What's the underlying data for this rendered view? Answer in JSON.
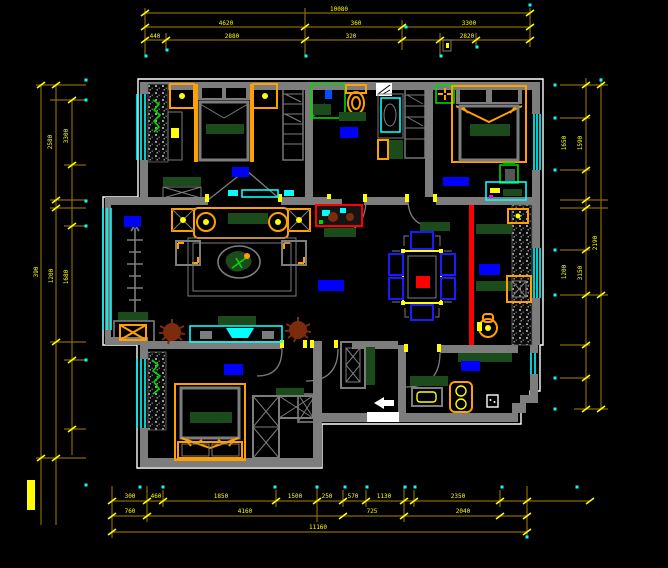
{
  "drawing": {
    "kind": "apartment floor plan (CAD)",
    "background": "#000000"
  },
  "palette": {
    "bg": "#000000",
    "wall": "#7d7d7d",
    "outline": "#ffffff",
    "dim_line": "#8a6a00",
    "dim_text": "#ffff00",
    "yellow": "#ffff00",
    "cyan": "#00ffff",
    "orange": "#ffa000",
    "dgreen": "#1b4a1b",
    "green": "#00d800",
    "chair_blue": "#1a1aff",
    "label_blue": "#0000ff",
    "red": "#ff0000",
    "brown": "#7c2b0c"
  },
  "dimensions": {
    "top": [
      {
        "x": 339,
        "y": 11,
        "v": "10080",
        "rot": 0
      },
      {
        "x": 226,
        "y": 25,
        "v": "4620",
        "rot": 0
      },
      {
        "x": 356,
        "y": 25,
        "v": "360",
        "rot": 0
      },
      {
        "x": 469,
        "y": 25,
        "v": "3300",
        "rot": 0
      },
      {
        "x": 155,
        "y": 38,
        "v": "440",
        "rot": 0
      },
      {
        "x": 232,
        "y": 38,
        "v": "2880",
        "rot": 0
      },
      {
        "x": 351,
        "y": 38,
        "v": "320",
        "rot": 0
      },
      {
        "x": 467,
        "y": 38,
        "v": "2820",
        "rot": 0
      }
    ],
    "bottom": [
      {
        "x": 130,
        "y": 498,
        "v": "300",
        "rot": 0
      },
      {
        "x": 156,
        "y": 498,
        "v": "460",
        "rot": 0
      },
      {
        "x": 221,
        "y": 498,
        "v": "1850",
        "rot": 0
      },
      {
        "x": 295,
        "y": 498,
        "v": "1500",
        "rot": 0
      },
      {
        "x": 327,
        "y": 498,
        "v": "250",
        "rot": 0
      },
      {
        "x": 353,
        "y": 498,
        "v": "570",
        "rot": 0
      },
      {
        "x": 384,
        "y": 498,
        "v": "1130",
        "rot": 0
      },
      {
        "x": 458,
        "y": 498,
        "v": "2350",
        "rot": 0
      },
      {
        "x": 130,
        "y": 513,
        "v": "760",
        "rot": 0
      },
      {
        "x": 245,
        "y": 513,
        "v": "4160",
        "rot": 0
      },
      {
        "x": 372,
        "y": 513,
        "v": "725",
        "rot": 0
      },
      {
        "x": 463,
        "y": 513,
        "v": "2040",
        "rot": 0
      },
      {
        "x": 318,
        "y": 529,
        "v": "11160",
        "rot": 0
      }
    ],
    "left": [
      {
        "x": 52,
        "y": 142,
        "v": "2580",
        "rot": -90
      },
      {
        "x": 68,
        "y": 136,
        "v": "3300",
        "rot": -90
      },
      {
        "x": 38,
        "y": 272,
        "v": "390",
        "rot": -90
      },
      {
        "x": 53,
        "y": 276,
        "v": "1200",
        "rot": -90
      },
      {
        "x": 68,
        "y": 277,
        "v": "1680",
        "rot": -90
      }
    ],
    "right": [
      {
        "x": 566,
        "y": 143,
        "v": "1650",
        "rot": -90
      },
      {
        "x": 582,
        "y": 143,
        "v": "1590",
        "rot": -90
      },
      {
        "x": 597,
        "y": 243,
        "v": "2190",
        "rot": -90
      },
      {
        "x": 566,
        "y": 272,
        "v": "1200",
        "rot": -90
      },
      {
        "x": 582,
        "y": 273,
        "v": "3150",
        "rot": -90
      }
    ]
  },
  "room_markers": [
    {
      "room": "balcony",
      "x": 124,
      "y": 216,
      "w": 17,
      "h": 11
    },
    {
      "room": "bedroom-top-left",
      "x": 232,
      "y": 167,
      "w": 17,
      "h": 10
    },
    {
      "room": "bathroom",
      "x": 340,
      "y": 127,
      "w": 18,
      "h": 11
    },
    {
      "room": "bedroom-top-right",
      "x": 443,
      "y": 177,
      "w": 26,
      "h": 9
    },
    {
      "room": "living-room",
      "x": 318,
      "y": 280,
      "w": 26,
      "h": 11
    },
    {
      "room": "dining-area",
      "x": 479,
      "y": 264,
      "w": 21,
      "h": 11
    },
    {
      "room": "bedroom-bottom-left",
      "x": 224,
      "y": 364,
      "w": 19,
      "h": 11
    },
    {
      "room": "kitchen",
      "x": 461,
      "y": 361,
      "w": 19,
      "h": 10
    }
  ]
}
